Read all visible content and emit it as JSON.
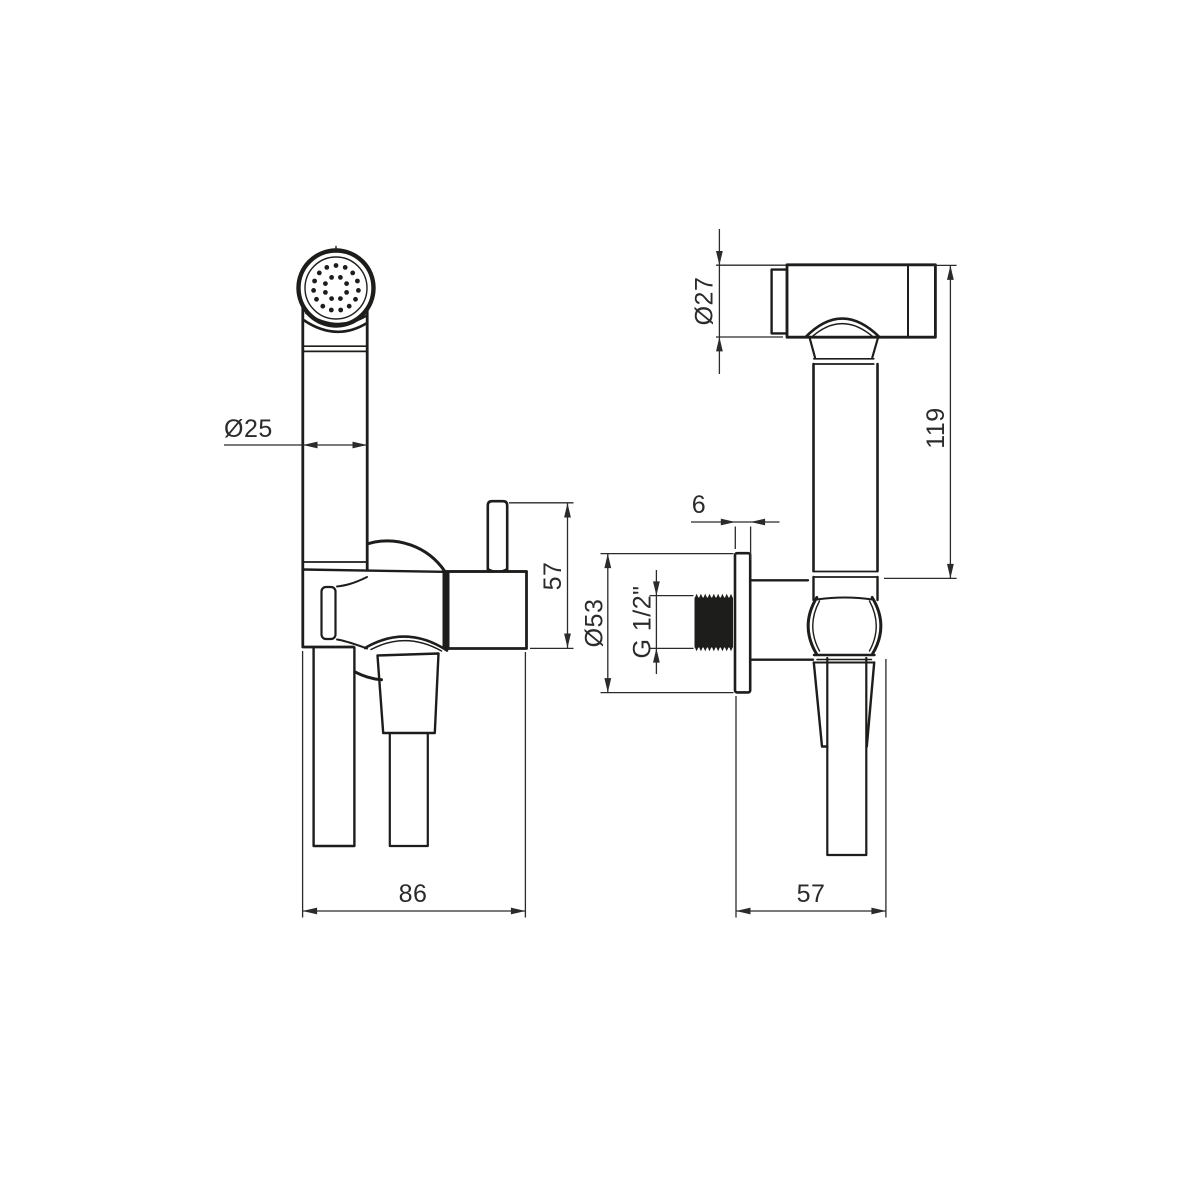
{
  "page": {
    "background": "#ffffff"
  },
  "drawing": {
    "line_color": "#1d1d1b",
    "dimension_color": "#2b2b2b",
    "dimensions": {
      "handle_diameter": "Ø25",
      "front_overall_width": "86",
      "valve_height": "57",
      "head_diameter": "Ø27",
      "sprayer_length": "119",
      "escutcheon_thickness": "6",
      "escutcheon_diameter": "Ø53",
      "thread_size": "G 1/2\"",
      "side_overall_depth": "57"
    }
  }
}
